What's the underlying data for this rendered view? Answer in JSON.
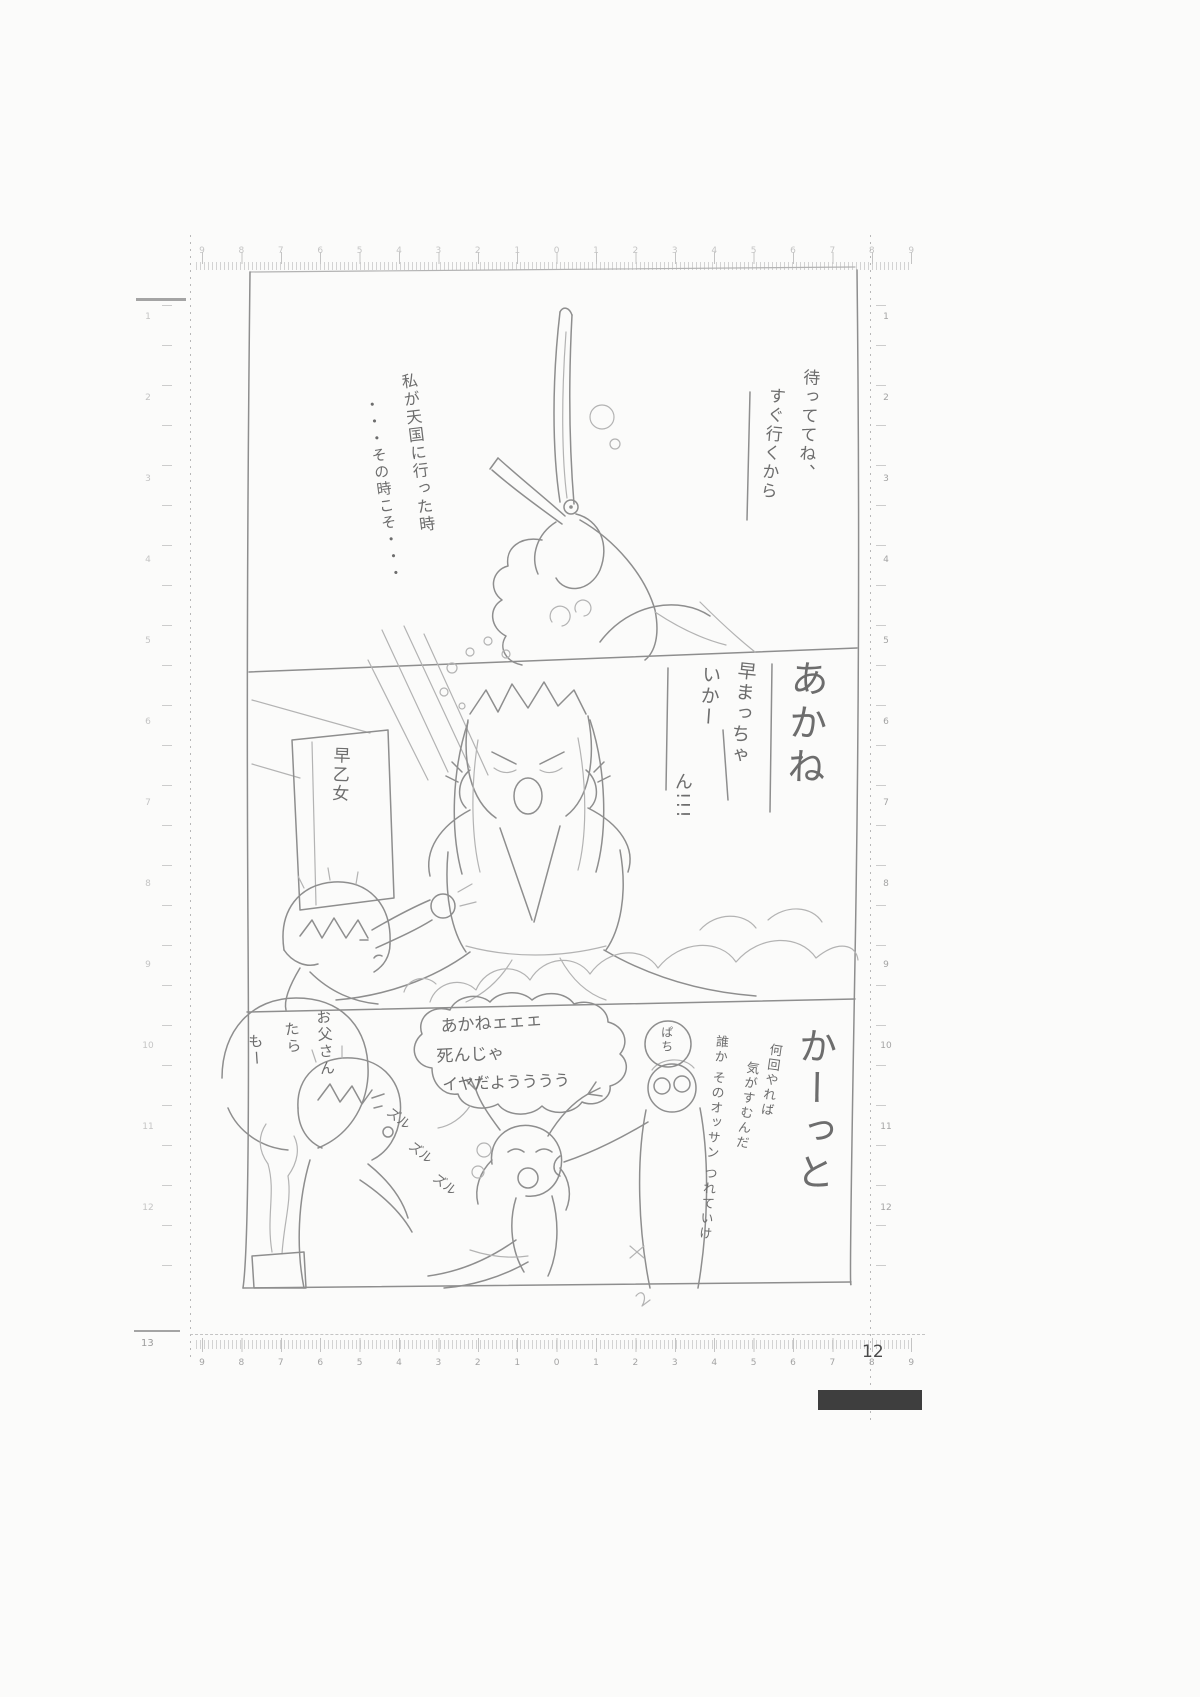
{
  "page": {
    "number": "12"
  },
  "rulers": {
    "top_numbers": [
      "9",
      "8",
      "7",
      "6",
      "5",
      "4",
      "3",
      "2",
      "1",
      "0",
      "1",
      "2",
      "3",
      "4",
      "5",
      "6",
      "7",
      "8",
      "9"
    ],
    "bottom_numbers": [
      "9",
      "8",
      "7",
      "6",
      "5",
      "4",
      "3",
      "2",
      "1",
      "0",
      "1",
      "2",
      "3",
      "4",
      "5",
      "6",
      "7",
      "8",
      "9"
    ],
    "left_numbers": [
      "1",
      "2",
      "3",
      "4",
      "5",
      "6",
      "7",
      "8",
      "9",
      "10",
      "11",
      "12"
    ],
    "right_numbers": [
      "1",
      "2",
      "3",
      "4",
      "5",
      "6",
      "7",
      "8",
      "9",
      "10",
      "11",
      "12"
    ],
    "bottom_left_corner": "13"
  },
  "panel1": {
    "bubble_right": {
      "col1": "待っててね、",
      "col2": "すぐ行くから"
    },
    "caption_left": {
      "col1": "私が天国に行った時",
      "col2": "・・・その時こそ・・・"
    }
  },
  "panel2": {
    "shout_large": "あかね",
    "shout_col1": "早まっちゃ",
    "shout_col2": "いかー",
    "shout_col3": "ん!!!",
    "sign": "早乙女"
  },
  "panel3": {
    "bubble_akane": {
      "col1": "お父さん",
      "col2": "たら",
      "col3": "もー"
    },
    "bubble_cloud": {
      "line1": "あかねェェェ",
      "line2": "死んじゃ",
      "line3": "イヤだようううう"
    },
    "bubble_small": "ぱち",
    "sfx": [
      "ズル",
      "ズル",
      "ズル"
    ],
    "caption_col1": "何回やれば",
    "caption_col2": "気がすむんだ",
    "caption_col3": "誰か そのオッサン つれていけ",
    "shout_large": "かーっと"
  },
  "colors": {
    "pencil": "#8e8e8e",
    "pencil_light": "#b3b3b3",
    "paper": "#fbfbfa",
    "footer_bar": "#3e3e3e",
    "ruler_print": "#a3a3a3"
  }
}
